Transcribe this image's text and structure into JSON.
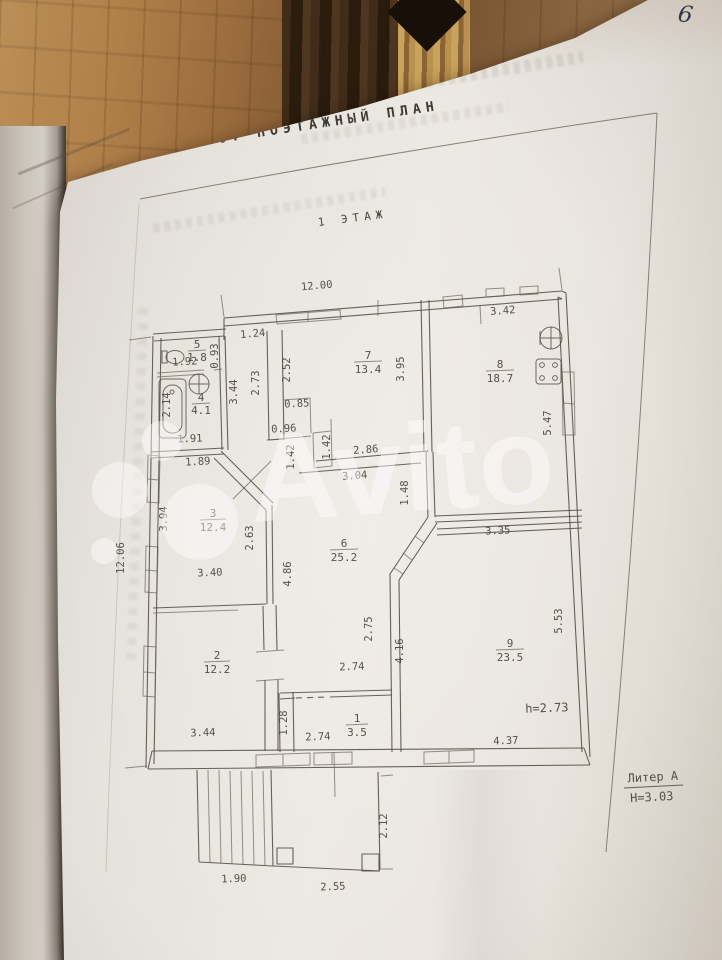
{
  "photo": {
    "page_number": "6"
  },
  "document": {
    "section_title": "6. ПОЭТАЖНЫЙ ПЛАН",
    "floor_label": "1 ЭТАЖ",
    "liter_label": "Литер А",
    "building_height": "Н=3.03",
    "ceiling_height": "h=2.73"
  },
  "watermark": {
    "text": "Avito"
  },
  "rooms": [
    {
      "num": "5",
      "area": "1.8"
    },
    {
      "num": "4",
      "area": "4.1"
    },
    {
      "num": "3",
      "area": "12.4"
    },
    {
      "num": "2",
      "area": "12.2"
    },
    {
      "num": "1",
      "area": "3.5"
    },
    {
      "num": "6",
      "area": "25.2"
    },
    {
      "num": "7",
      "area": "13.4"
    },
    {
      "num": "8",
      "area": "18.7"
    },
    {
      "num": "9",
      "area": "23.5"
    }
  ],
  "dims": [
    "12.00",
    "1.24",
    "0.93",
    "1.92",
    "2.73",
    "2.52",
    "3.95",
    "3.42",
    "5.47",
    "3.44",
    "0.85",
    "2.14",
    "1.91",
    "0.96",
    "1.42",
    "1.42",
    "2.86",
    "3.04",
    "1.89",
    "1.48",
    "3.35",
    "12.06",
    "3.94",
    "2.63",
    "3.40",
    "4.86",
    "5.53",
    "2.75",
    "2.74",
    "4.16",
    "1.28",
    "2.74",
    "3.44",
    "4.37",
    "1.90",
    "2.55",
    "2.12"
  ]
}
